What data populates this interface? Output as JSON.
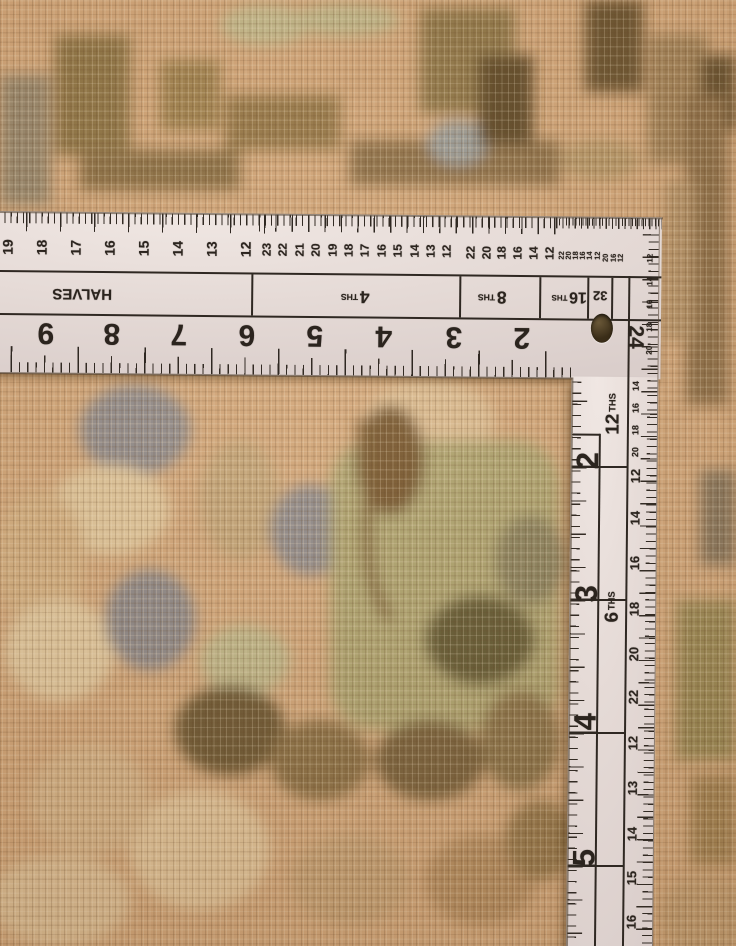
{
  "palette": {
    "rug_base": "#d7ab7e",
    "rug_olive": "#8d7545",
    "rug_dark_brown": "#6b5633",
    "rug_gray": "#8f8d91",
    "rug_cream": "#e8d0a6",
    "rug_sage": "#c2bc8e",
    "ruler_body": "#e7ddd9",
    "ruler_ink": "#2b241e"
  },
  "ruler": {
    "blade": {
      "top_scales": [
        {
          "values": [
            "19",
            "18",
            "17",
            "16",
            "15",
            "14",
            "13",
            "12"
          ],
          "x0": 8,
          "dx": 34,
          "cy": 247,
          "size": 14
        },
        {
          "values": [
            "23",
            "22",
            "21",
            "20",
            "19",
            "18",
            "17",
            "16",
            "15",
            "14",
            "13",
            "12"
          ],
          "x0": 267,
          "dx": 16.4,
          "cy": 247,
          "size": 12
        },
        {
          "values": [
            "22",
            "20",
            "18",
            "16",
            "14",
            "12"
          ],
          "x0": 471,
          "dx": 15.7,
          "cy": 248,
          "size": 12
        },
        {
          "values": [
            "22",
            "20",
            "18",
            "16",
            "14",
            "12"
          ],
          "x0": 562,
          "dx": 7.1,
          "cy": 250,
          "size": 7.5
        },
        {
          "values": [
            "20",
            "16",
            "12"
          ],
          "x0": 606,
          "dx": 7.7,
          "cy": 252,
          "size": 7.5
        }
      ],
      "band_labels": [
        {
          "text": "HALVES",
          "x": 83,
          "y": 293,
          "size": 15
        },
        {
          "text": "4 THS",
          "x": 356,
          "y": 293,
          "size": 12
        },
        {
          "text": "8 THS",
          "x": 493,
          "y": 292,
          "size": 12
        },
        {
          "text": "16 THS",
          "x": 570,
          "y": 291,
          "size": 11
        },
        {
          "text": "32",
          "x": 601,
          "y": 290,
          "size": 13
        }
      ],
      "inch_numbers": [
        {
          "text": "9",
          "x": 47
        },
        {
          "text": "8",
          "x": 113
        },
        {
          "text": "7",
          "x": 180
        },
        {
          "text": "6",
          "x": 248
        },
        {
          "text": "5",
          "x": 316
        },
        {
          "text": "4",
          "x": 385
        },
        {
          "text": "3",
          "x": 455
        },
        {
          "text": "2",
          "x": 523
        }
      ],
      "inch_row_y": 332,
      "inch_size": 30,
      "corner_number": {
        "text": "24",
        "x": 637,
        "y": 331,
        "size": 21
      },
      "corner_side_numbers": {
        "x": 651,
        "size": 8,
        "items": [
          {
            "text": "12",
            "y": 252
          },
          {
            "text": "14",
            "y": 275
          },
          {
            "text": "16",
            "y": 298
          },
          {
            "text": "18",
            "y": 321
          },
          {
            "text": "20",
            "y": 344
          }
        ]
      }
    },
    "tongue": {
      "band_labels": [
        {
          "text": "12 THS",
          "x": 615,
          "y": 408,
          "size": 13
        },
        {
          "text": "6 THS",
          "x": 616,
          "y": 601,
          "size": 13
        }
      ],
      "inch_numbers": {
        "x": 590,
        "size": 31,
        "items": [
          {
            "text": "2",
            "y": 455
          },
          {
            "text": "3",
            "y": 588
          },
          {
            "text": "4",
            "y": 716
          },
          {
            "text": "5",
            "y": 852
          }
        ]
      },
      "edge_numbers": {
        "x": 638,
        "items": [
          {
            "text": "14",
            "y": 380,
            "size": 9
          },
          {
            "text": "16",
            "y": 402,
            "size": 9
          },
          {
            "text": "18",
            "y": 424,
            "size": 9
          },
          {
            "text": "20",
            "y": 446,
            "size": 9
          },
          {
            "text": "12",
            "y": 470,
            "size": 13
          },
          {
            "text": "14",
            "y": 512,
            "size": 13
          },
          {
            "text": "16",
            "y": 557,
            "size": 13
          },
          {
            "text": "18",
            "y": 603,
            "size": 13
          },
          {
            "text": "20",
            "y": 648,
            "size": 13
          },
          {
            "text": "22",
            "y": 691,
            "size": 13
          },
          {
            "text": "12",
            "y": 737,
            "size": 13
          },
          {
            "text": "13",
            "y": 782,
            "size": 13
          },
          {
            "text": "14",
            "y": 828,
            "size": 13
          },
          {
            "text": "15",
            "y": 872,
            "size": 13
          },
          {
            "text": "16",
            "y": 916,
            "size": 13
          }
        ]
      }
    }
  }
}
